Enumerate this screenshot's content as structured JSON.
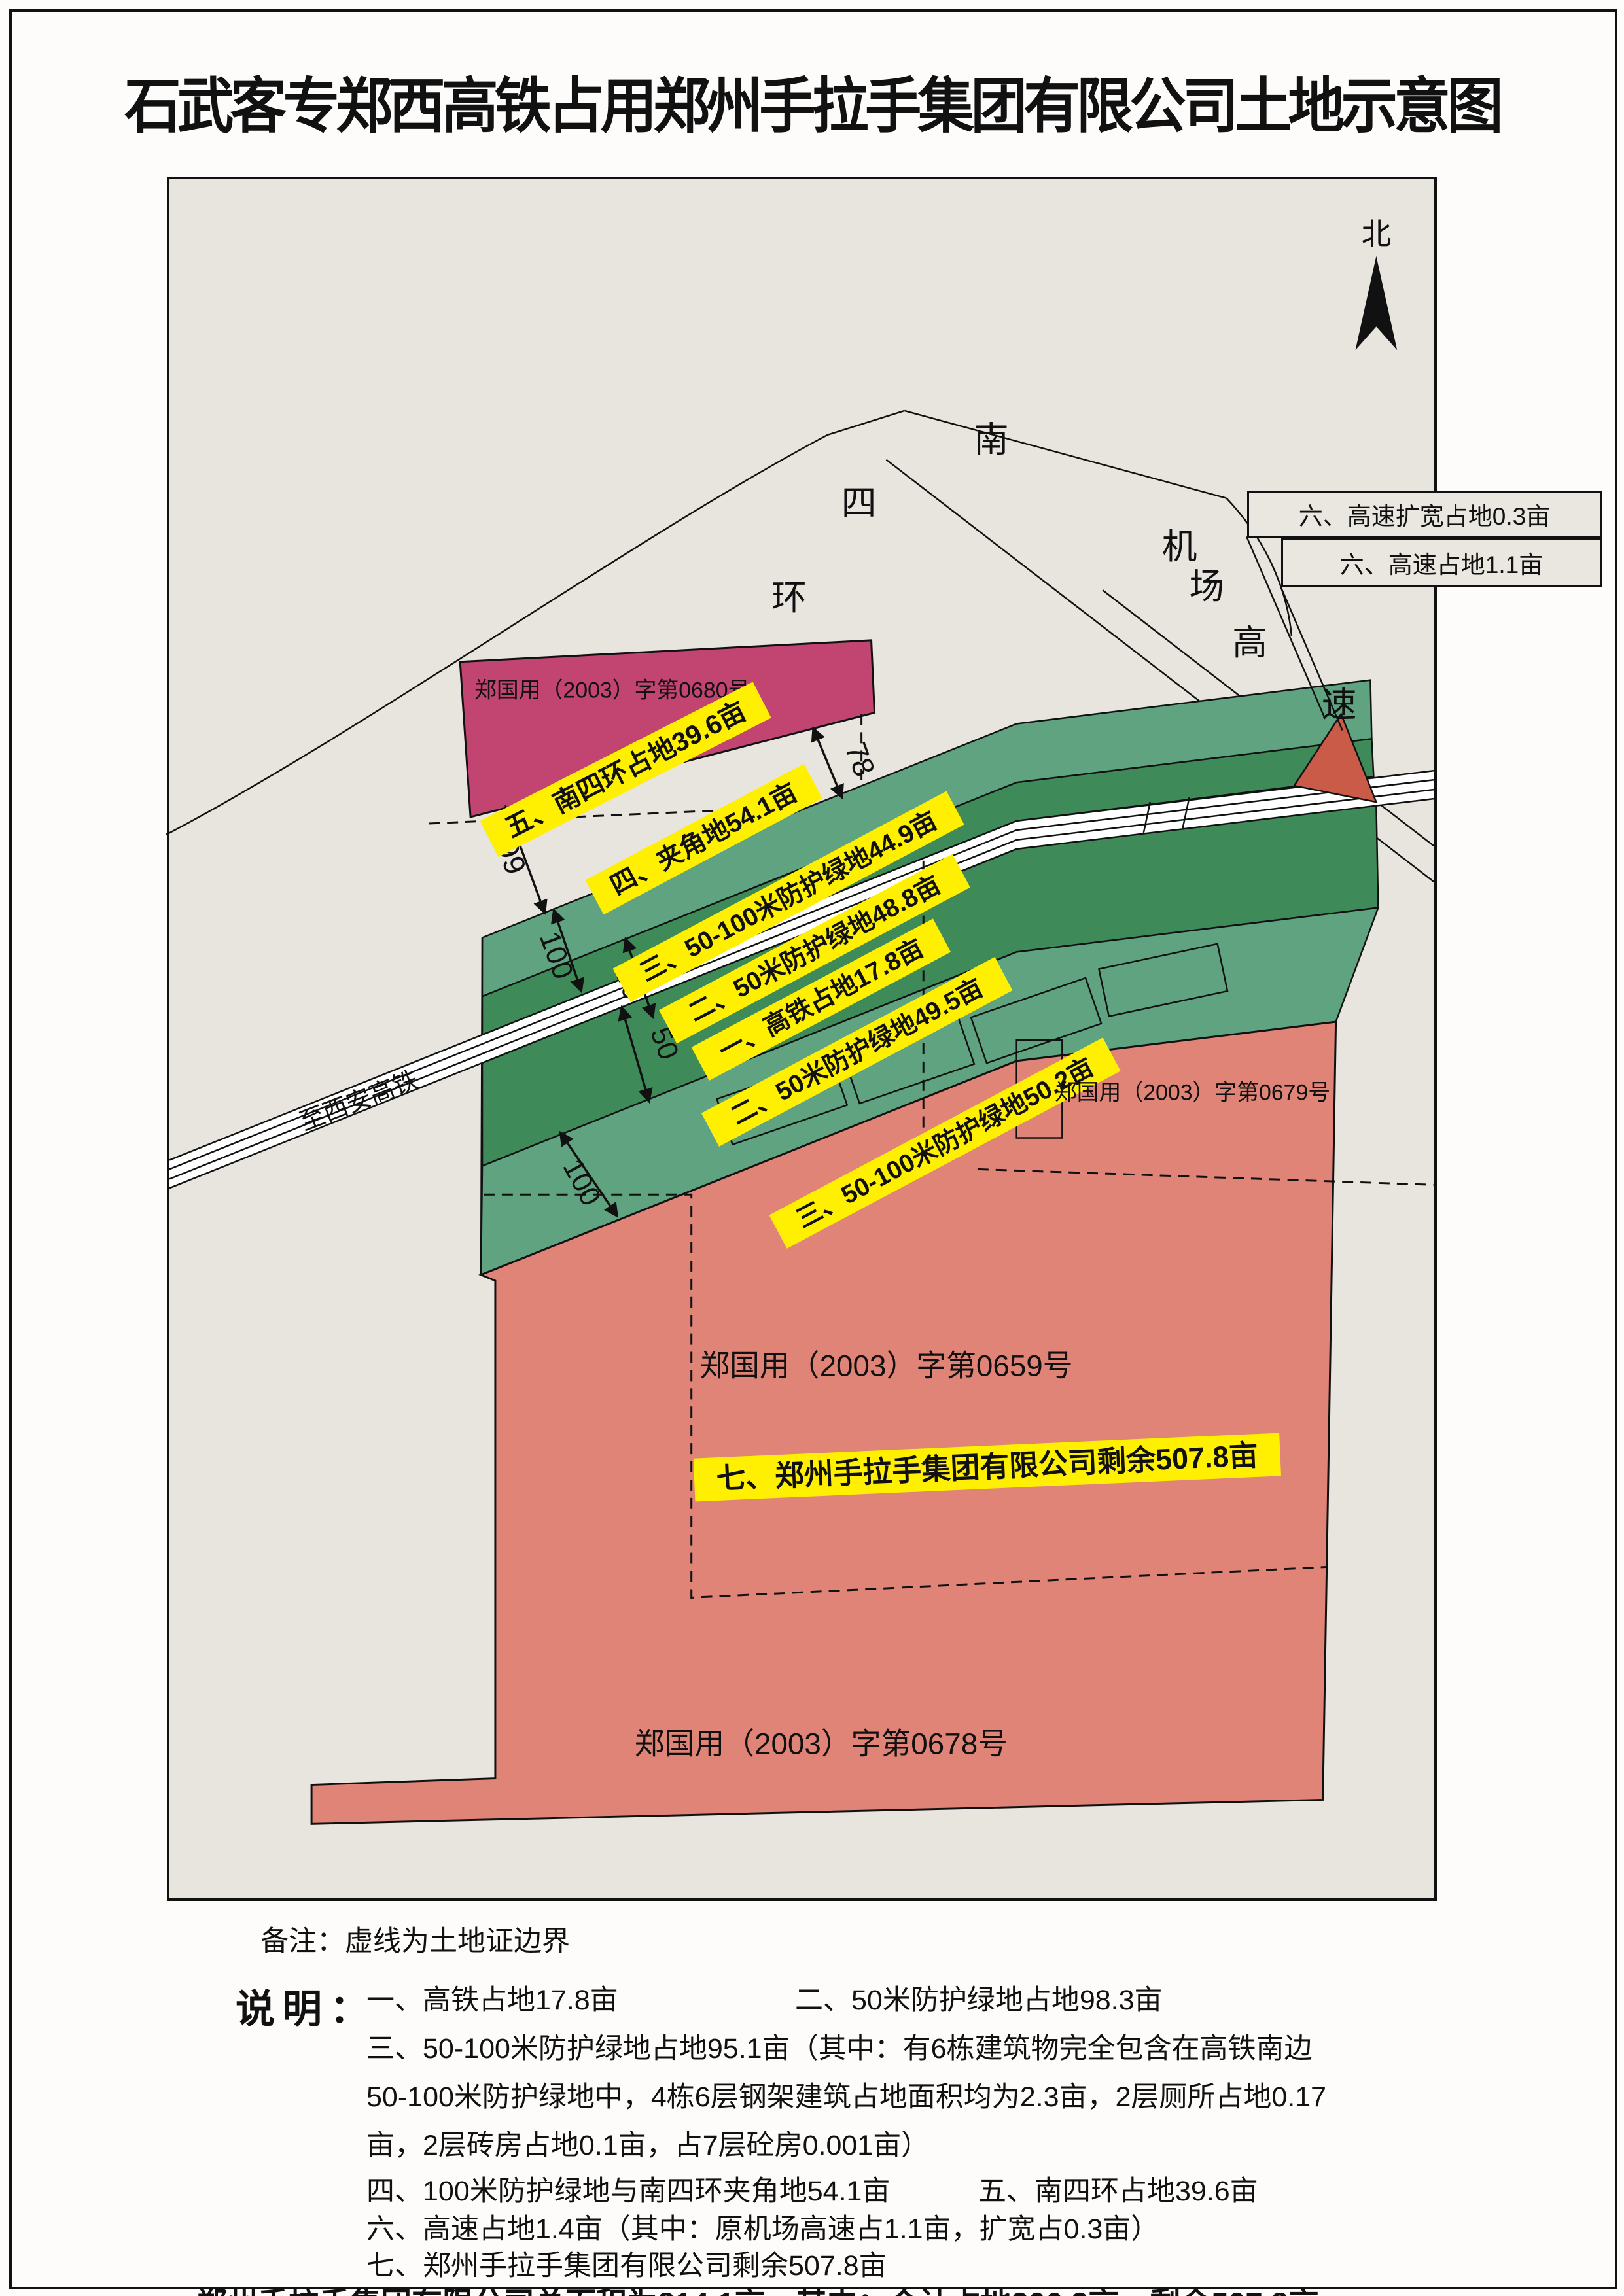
{
  "title": "石武客专郑西高铁占用郑州手拉手集团有限公司土地示意图",
  "map": {
    "north_label": "北",
    "roads": {
      "nansihuan": [
        "南",
        "四",
        "环"
      ],
      "jichang": [
        "机",
        "场"
      ],
      "gaosu": [
        "高",
        "速"
      ],
      "rail_label": "至西安高铁"
    },
    "certificates": {
      "c0680": "郑国用（2003）字第0680号",
      "c0679": "郑国用（2003）字第0679号",
      "c0659": "郑国用（2003）字第0659号",
      "c0678": "郑国用（2003）字第0678号"
    },
    "highlights": {
      "y5": "五、南四环占地39.6亩",
      "y4": "四、夹角地54.1亩",
      "y3a": "三、50-100米防护绿地44.9亩",
      "y2a": "二、50米防护绿地48.8亩",
      "y1": "一、高铁占地17.8亩",
      "y2b": "二、50米防护绿地49.5亩",
      "y3b": "三、50-100米防护绿地50.2亩",
      "y7": "七、郑州手拉手集团有限公司剩余507.8亩"
    },
    "callouts": {
      "box1": "六、高速扩宽占地0.3亩",
      "box2": "六、高速占地1.1亩"
    },
    "dimensions": {
      "d78": "78",
      "d99": "99",
      "d100a": "100",
      "d50a": "50",
      "d50b": "50",
      "d100b": "100"
    }
  },
  "notes": {
    "beizhu": "备注：虚线为土地证边界",
    "shuoming_label": "说明：",
    "items": [
      "一、高铁占地17.8亩",
      "二、50米防护绿地占地98.3亩",
      "三、50-100米防护绿地占地95.1亩（其中：有6栋建筑物完全包含在高铁南边",
      "50-100米防护绿地中，4栋6层钢架建筑占地面积均为2.3亩，2层厕所占地0.17",
      "亩，2层砖房占地0.1亩，占7层砼房0.001亩）",
      "四、100米防护绿地与南四环夹角地54.1亩",
      "五、南四环占地39.6亩",
      "六、高速占地1.4亩（其中：原机场高速占1.1亩，扩宽占0.3亩）",
      "七、郑州手拉手集团有限公司剩余507.8亩"
    ],
    "total": "郑州手拉手集团有限公司总面积为814.1亩，其中：合计占地306.3亩，剩余507.8亩"
  },
  "palette": {
    "map_bg": "#e8e4de",
    "magenta_parcel": "#c14471",
    "dark_green_band": "#3e8a58",
    "light_green_band": "#5fa381",
    "pink_parcel": "#e08478",
    "highway_triangle": "#c95b48",
    "highlight_yellow": "#ffef00",
    "line_black": "#111111"
  }
}
